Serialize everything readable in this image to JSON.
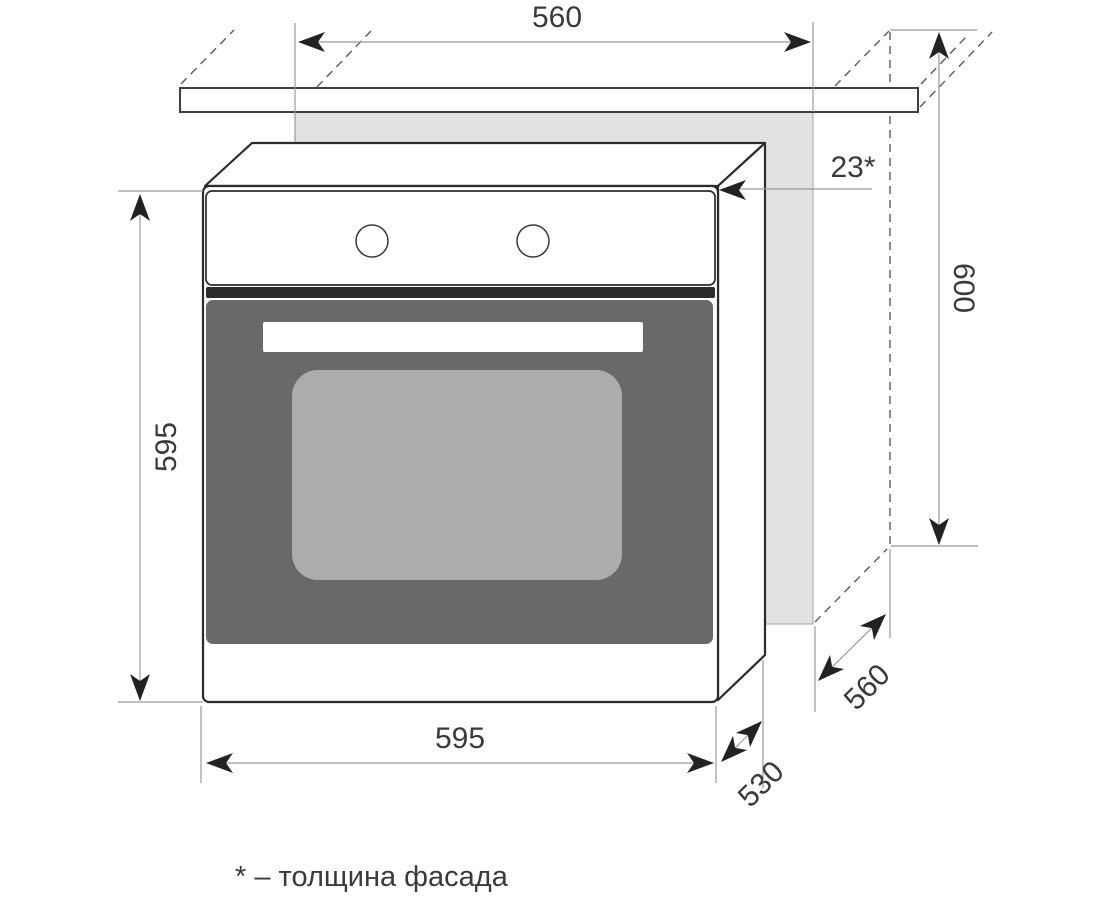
{
  "diagram": {
    "title": "built-in-oven-installation-dimensions",
    "dimensions": {
      "niche_width_top": "560",
      "facade_thickness": "23*",
      "cabinet_height": "600",
      "oven_height": "595",
      "oven_width": "595",
      "oven_depth": "530",
      "cabinet_depth": "560"
    },
    "footnote": "* – толщина фасада",
    "colors": {
      "door": "#696969",
      "door_window": "#acacac",
      "niche": "#e2e2e2",
      "outline": "#2b2b2b",
      "dimension_line": "#9a9a9a",
      "text": "#3a3a3a"
    }
  }
}
